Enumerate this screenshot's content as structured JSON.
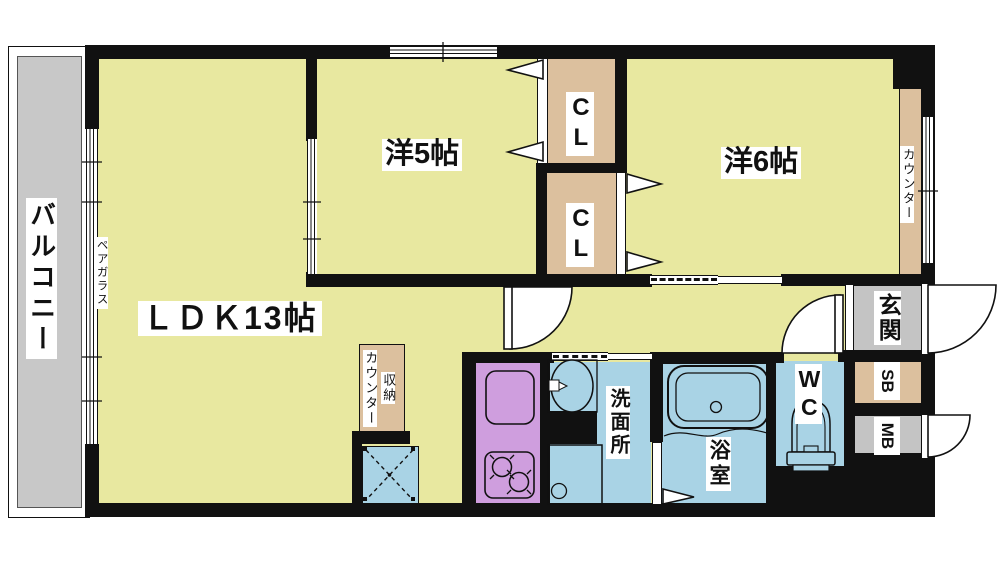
{
  "rooms": {
    "balcony": "バルコニー",
    "ldk": "ＬＤＫ13帖",
    "western_room_5": "洋5帖",
    "western_room_6": "洋6帖",
    "closet_top": "CL",
    "closet_bottom": "CL",
    "washroom": "洗面所",
    "bathroom": "浴室",
    "toilet": "WC",
    "entrance": "玄関",
    "shoe_box": "SB",
    "meter_box": "MB"
  },
  "annotations": {
    "pair_glass": "ペアガラス",
    "counter_right": "カウンター",
    "storage": "収納",
    "storage_counter": "カウンター"
  },
  "colors": {
    "room_floor_yellow": "#e8e8a0",
    "closet_tan": "#dcc09e",
    "balcony_gray": "#c8c8c8",
    "wet_area_blue": "#a9d3e5",
    "kitchen_purple": "#cf9ede",
    "wall_black": "#111111"
  }
}
